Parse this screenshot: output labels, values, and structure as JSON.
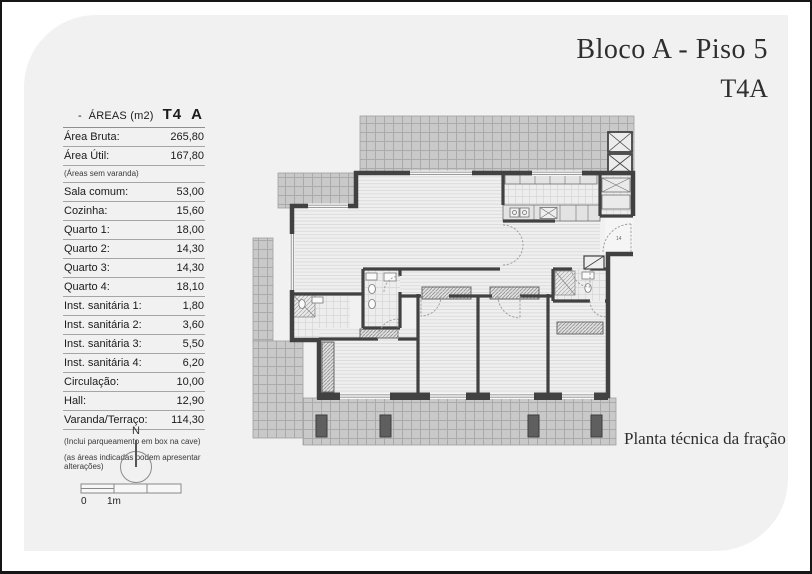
{
  "header": {
    "title": "Bloco A - Piso 5",
    "subtitle": "T4A"
  },
  "areas_table": {
    "dash": "-",
    "title": "ÁREAS (m2)",
    "unit_type": "T4",
    "fraction": "A",
    "rows": [
      {
        "label": "Área Bruta:",
        "value": "265,80"
      },
      {
        "label": "Área Útil:",
        "value": "167,80"
      },
      {
        "label": "(Áreas sem varanda)",
        "value": ""
      },
      {
        "label": "Sala comum:",
        "value": "53,00"
      },
      {
        "label": "Cozinha:",
        "value": "15,60"
      },
      {
        "label": "Quarto 1:",
        "value": "18,00"
      },
      {
        "label": "Quarto 2:",
        "value": "14,30"
      },
      {
        "label": "Quarto 3:",
        "value": "14,30"
      },
      {
        "label": "Quarto 4:",
        "value": "18,10"
      },
      {
        "label": "Inst. sanitária 1:",
        "value": "1,80"
      },
      {
        "label": "Inst. sanitária 2:",
        "value": "3,60"
      },
      {
        "label": "Inst. sanitária 3:",
        "value": "5,50"
      },
      {
        "label": "Inst. sanitária 4:",
        "value": "6,20"
      },
      {
        "label": "Circulação:",
        "value": "10,00"
      },
      {
        "label": "Hall:",
        "value": "12,90"
      },
      {
        "label": "Varanda/Terraço:",
        "value": "114,30"
      }
    ],
    "footnotes": [
      "(Inclui parqueamento em box na cave)",
      "(as áreas indicadas podem apresentar alterações)"
    ]
  },
  "plan": {
    "caption": "Planta técnica da fração",
    "entry_door_label": "14"
  },
  "compass": {
    "north_label": "N"
  },
  "scale_bar": {
    "start_label": "0",
    "meter_label": "1m"
  },
  "colors": {
    "panel_bg": "#f1f1f1",
    "wall": "#414141",
    "terrace_fill": "#c9c9c9",
    "terrace_grid_line": "#aaaaaa",
    "wood_floor": "#efefef",
    "planter": "#5f5f5f",
    "text": "#1b1b1b"
  }
}
